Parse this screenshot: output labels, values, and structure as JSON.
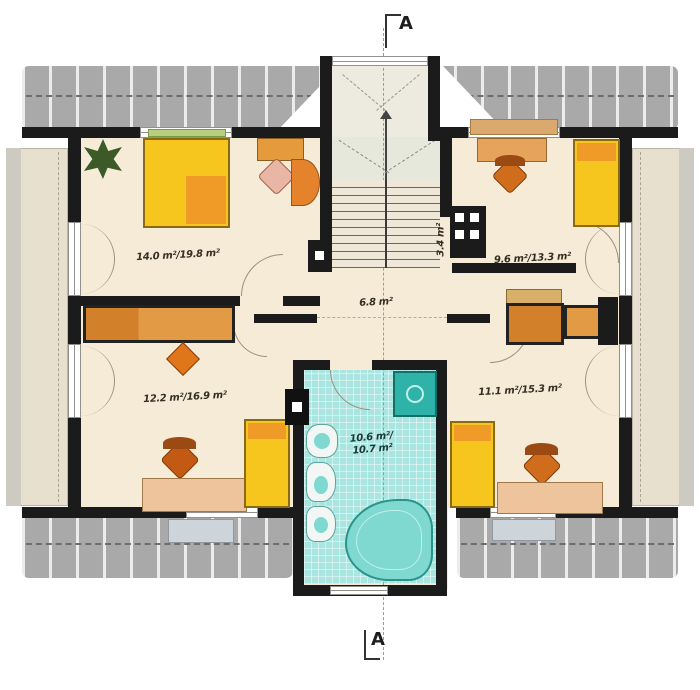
{
  "plan": {
    "title": "attic floor plan",
    "section_marker_top": "A",
    "section_marker_bottom": "A",
    "rooms": [
      {
        "name": "bedroom-top-left",
        "area_label": "14.0 m²/19.8 m²"
      },
      {
        "name": "bedroom-top-right",
        "area_label": "9.6 m²/13.3 m²"
      },
      {
        "name": "stair-closet",
        "area_label": "3.4 m²"
      },
      {
        "name": "hall",
        "area_label": "6.8 m²"
      },
      {
        "name": "bedroom-bottom-left",
        "area_label": "12.2 m²/16.9 m²"
      },
      {
        "name": "bedroom-bottom-right",
        "area_label": "11.1 m²/15.3 m²"
      },
      {
        "name": "bathroom",
        "area_label_line1": "10.6 m²/",
        "area_label_line2": "10.7 m²"
      }
    ],
    "colors": {
      "wall": "#1b1b1b",
      "floor": "#f5ebd7",
      "roof_band": "#a9a9a9",
      "eaves": "#e8e0ce",
      "bathroom_tile": "#a9e6e1",
      "shower": "#2fb3a9",
      "bathtub": "#7fd9d0",
      "bed_yellow": "#f6c51e",
      "pillow_orange": "#f09a28",
      "wardrobe_orange": "#d2802a",
      "desk_tan": "#eec49c",
      "chair_orange": "#cf6d1d",
      "stair_landing": "#e7e8dc",
      "plant_green": "#3c5a28"
    }
  }
}
